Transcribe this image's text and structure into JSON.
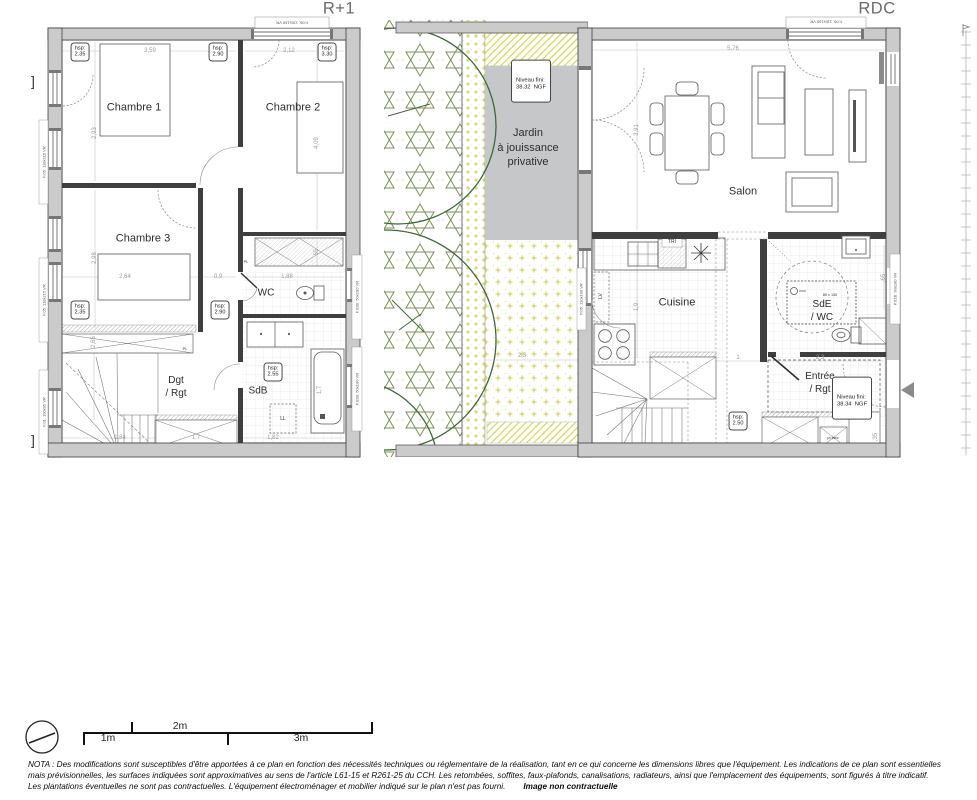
{
  "colors": {
    "wall": "#cbcbcb",
    "line": "#3f3f3f",
    "garden_green": "#7a9252",
    "tree_green": "#3e6b35",
    "yellow": "#d5d84f",
    "jardin_gray": "#c5c7c9"
  },
  "titles": {
    "left": "R+1",
    "right": "RDC"
  },
  "r1": {
    "rooms": {
      "chambre1": "Chambre 1",
      "chambre2": "Chambre 2",
      "chambre3": "Chambre 3",
      "wc": "WC",
      "sdb": "SdB",
      "dgt": "Dgt\n/ Rgt"
    },
    "labels": {
      "ll": "LL",
      "pl": "PL"
    },
    "hsp": [
      {
        "label": "hsp:",
        "value": "2.35"
      },
      {
        "label": "hsp:",
        "value": "2.90"
      },
      {
        "label": "hsp:",
        "value": "3.30"
      },
      {
        "label": "hsp:",
        "value": "2.35"
      },
      {
        "label": "hsp:",
        "value": "2.90"
      },
      {
        "label": "hsp:",
        "value": "2.55"
      }
    ],
    "dims": {
      "top1": "3,59",
      "top2": "2,12",
      "c1_h": "2,93",
      "c2_h": "4,09",
      "c3_h": "2,98",
      "mid1": "2,64",
      "mid2": "0,9",
      "mid3": "1,88",
      "left_low": "2,65",
      "bot1": "1,84",
      "bot2": "1,7",
      "bot3": "1,82",
      "sdb_h": "1,7",
      "wc_h": "65"
    },
    "windows": {
      "top": "F.06. 110x160 VR",
      "left1": "F.05. 110x215 VR",
      "left2": "F.05. 110x215 VR",
      "left3": "F.01. 100x95 VR",
      "right1": "F.02B. 50x190 VR",
      "right2": "F.02B. 50x190 VR"
    }
  },
  "garden": {
    "label": "Jardin\nà jouissance\nprivative",
    "niveau": {
      "label": "Niveau fini:",
      "value": "38.32  NGF"
    },
    "dim": "2,3"
  },
  "rdc": {
    "rooms": {
      "salon": "Salon",
      "cuisine": "Cuisine",
      "sde": "SdE\n/ WC",
      "entree": "Entrée\n/ Rgt"
    },
    "labels": {
      "tri": "TRI",
      "lv": "LV",
      "shower": "80 x 130",
      "ptelec": "pt élec"
    },
    "hsp": {
      "label": "hsp:",
      "value": "2.50"
    },
    "niveau": {
      "label": "Niveau fini:",
      "value": "38.34  NGF"
    },
    "dims": {
      "top": "5,76",
      "salon_v": "3,91",
      "cuisine_v": "1,9",
      "entree1": "1",
      "entree2": "2,3",
      "sde_v": ",65",
      "bot_v": ",35"
    },
    "windows": {
      "top": "F.06. 110x160 VR",
      "left": "P.05. 110x190 VR",
      "right": "P.01B. 90x190 VR"
    }
  },
  "scalebar": {
    "m1": "1m",
    "m2": "2m",
    "m3": "3m"
  },
  "annotations": {
    "bracket": "]"
  },
  "nota": {
    "line1": "NOTA : Des modifications sont susceptibles d'être apportées à ce plan en fonction des nécessités techniques ou réglementaire de la réalisation, tant en ce qui concerne les dimensions libres que l'équipement. Les indications de ce plan sont essentielles",
    "line2": "mais prévisionnelles, les surfaces indiquées sont approximatives au sens de l'article L61-15 et R261-25 du CCH. Les retombées, soffites, faux-plafonds, canalisations, radiateurs, ainsi que l'emplacement des équipements, sont figurés à titre indicatif.",
    "line3": "Les plantations éventuelles ne sont pas contractuelles. L'équipement électroménager et mobilier indiqué sur le plan n'est pas fourni.",
    "note": "Image non contractuelle"
  }
}
